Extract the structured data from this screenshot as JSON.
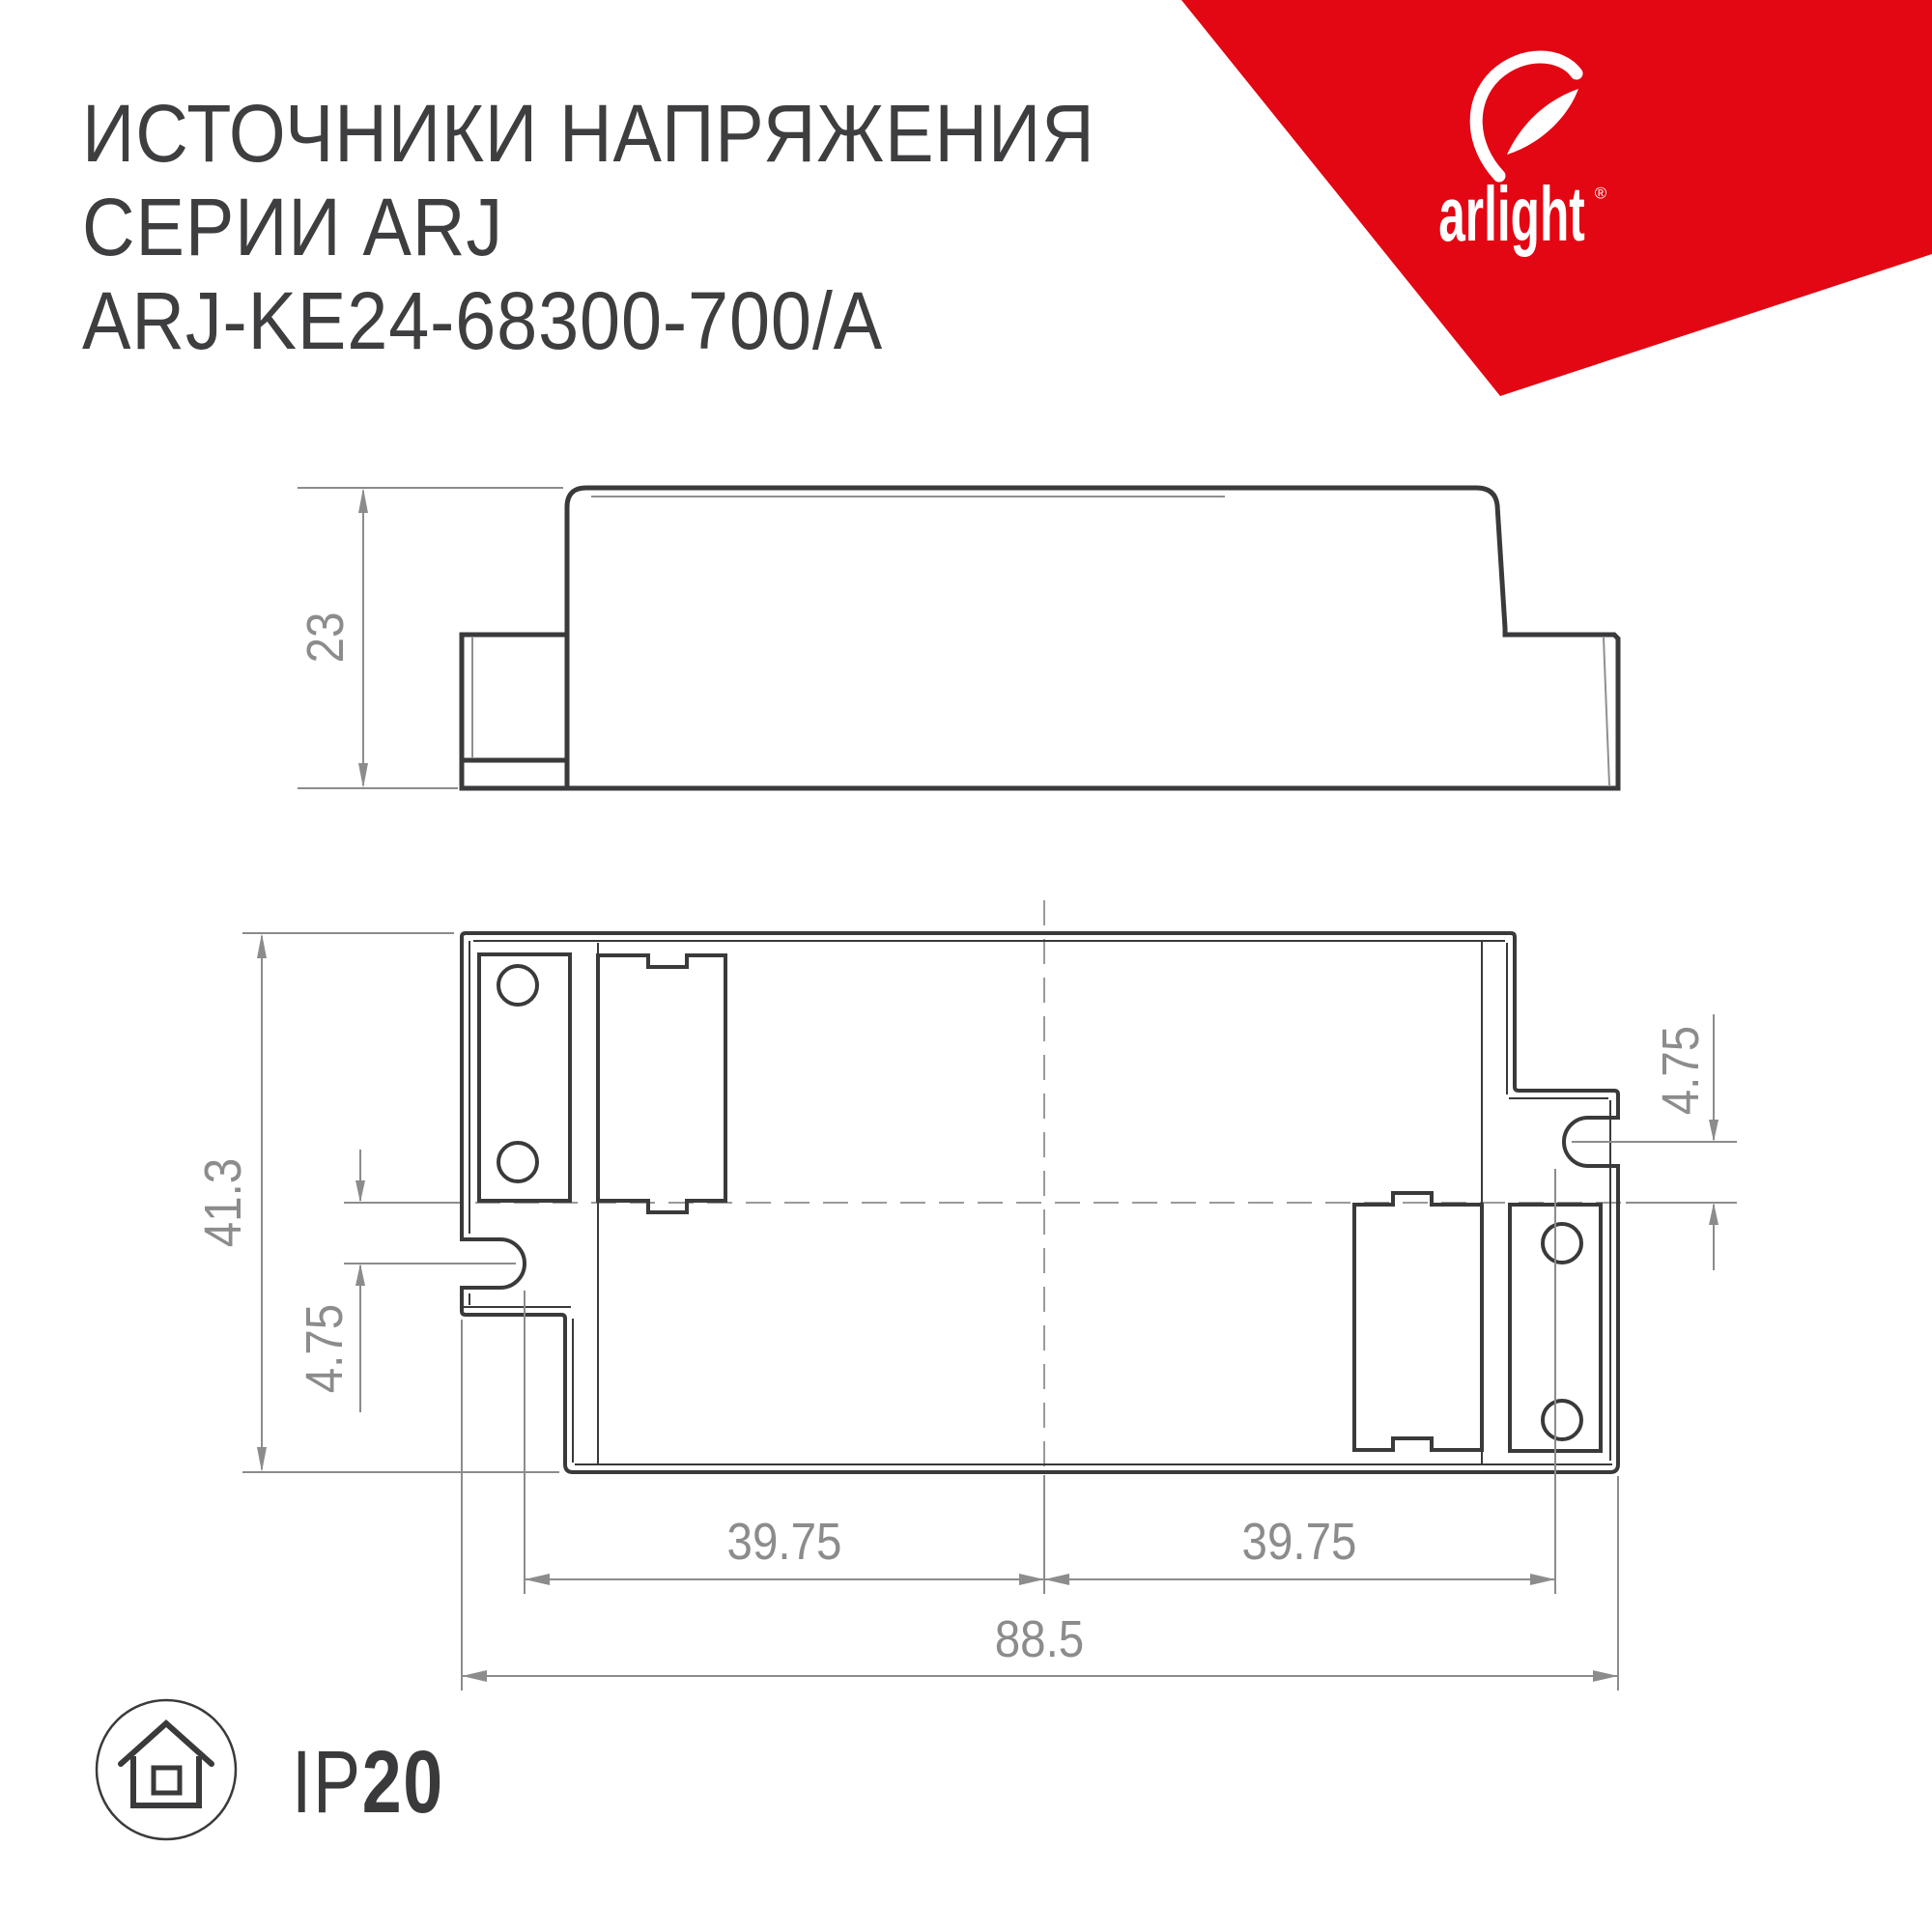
{
  "title": {
    "line1": "ИСТОЧНИКИ НАПРЯЖЕНИЯ",
    "line2": "СЕРИИ ARJ",
    "line3": "ARJ-KE24-68300-700/A"
  },
  "brand": {
    "wordmark": "arlight",
    "registered": "®"
  },
  "side_view": {
    "height_dim": "23"
  },
  "plan_view": {
    "height_dim": "41.3",
    "slot_offset_left_dim": "4.75",
    "slot_offset_right_dim": "4.75",
    "hole_span_left_dim": "39.75",
    "hole_span_right_dim": "39.75",
    "overall_width_dim": "88.5"
  },
  "footer": {
    "ip_prefix": "IP",
    "ip_value": "20",
    "icon": "house-in-circle-icon"
  },
  "colors": {
    "brand_red": "#e30613",
    "drawing_line": "#3a3a3c",
    "dimension_gray": "#8c8c8c",
    "background": "#ffffff"
  }
}
